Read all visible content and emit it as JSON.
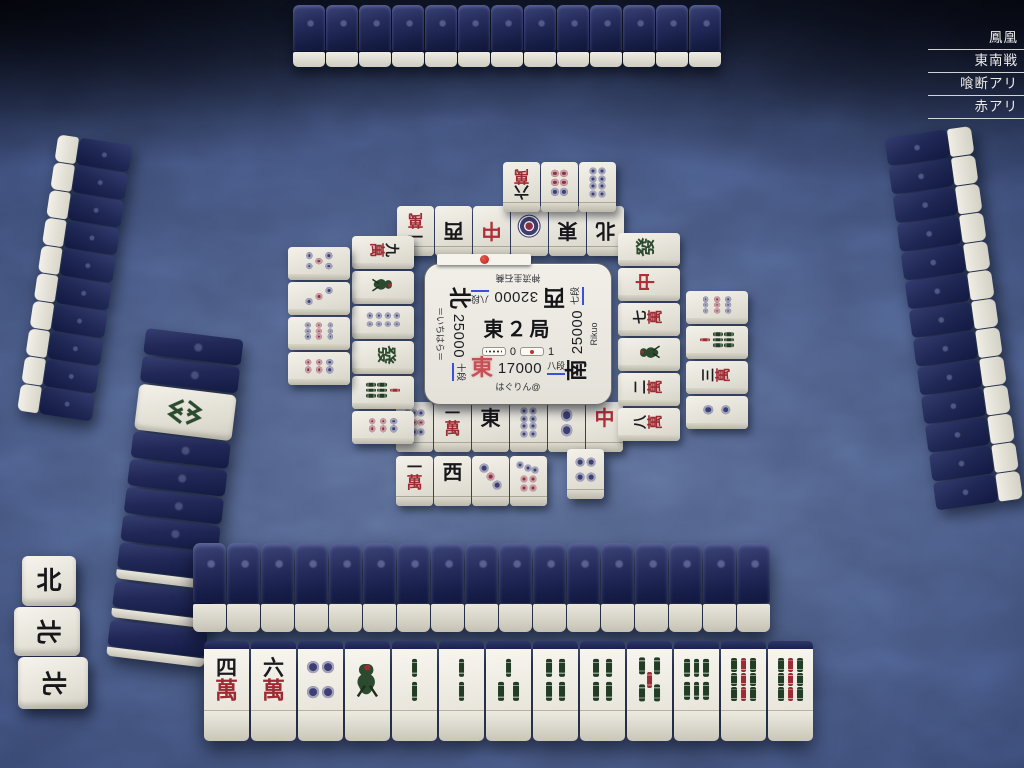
{
  "ruleset": {
    "items": [
      {
        "label": "鳳凰"
      },
      {
        "label": "東南戦"
      },
      {
        "label": "喰断アリ"
      },
      {
        "label": "赤アリ"
      }
    ]
  },
  "center_panel": {
    "round_label": "東２局",
    "hundred_sticks": "0",
    "riichi_sticks": "1",
    "players": {
      "bottom": {
        "wind": "東",
        "score": "17000",
        "rank": "八段",
        "name": "はぐりん@",
        "dealer": true
      },
      "right": {
        "wind": "南",
        "score": "25000",
        "rank": "七段",
        "name": "Rikuo",
        "dealer": false
      },
      "top": {
        "wind": "西",
        "score": "32000",
        "rank": "八段",
        "name": "神流圭石蕎",
        "dealer": false
      },
      "left": {
        "wind": "北",
        "score": "25000",
        "rank": "十段",
        "name": "＝いちはら＝",
        "dealer": false
      }
    }
  },
  "board": {
    "bottom_hand": [
      "4m",
      "6m",
      "4p",
      "1s",
      "2s",
      "2s",
      "3s",
      "4s",
      "4s",
      "5s",
      "6s",
      "9s",
      "9s"
    ],
    "discards": {
      "bottom": {
        "row1": [
          "9p",
          "1m",
          "E",
          "8p",
          "2p",
          "C"
        ],
        "row2": [
          "1m",
          "W",
          "3p",
          "7p"
        ],
        "latest": "4p"
      },
      "top": {
        "row1": [
          "1m",
          "W",
          "C",
          "1p",
          "E",
          "N"
        ],
        "row2": [
          "6m",
          "6p",
          "8p"
        ]
      },
      "left": {
        "row1": [
          "9m",
          "1s",
          "8p",
          "F",
          "7s",
          "6p"
        ],
        "row2": [
          "5p",
          "3p",
          "9p",
          "6p"
        ]
      },
      "right": {
        "row1": [
          "F",
          "C",
          "7m",
          "1s",
          "2m",
          "8m"
        ],
        "row2": [
          "9p",
          "7s",
          "3m",
          "2p"
        ]
      }
    },
    "left_meld": {
      "owner": "left",
      "tiles": [
        "N",
        "N",
        "N"
      ],
      "called_index": 0
    },
    "dora_indicator": "8s",
    "left_wall_slots": [
      "back",
      "back",
      "dora",
      "back",
      "back",
      "back",
      "back",
      "back2",
      "back2",
      "back2"
    ],
    "wall_counts": {
      "top_hand": 13,
      "right_hand": 13,
      "left_hand": 10,
      "bottom_wall": 17
    }
  },
  "glyphs": {
    "winds": {
      "E": "東",
      "S": "南",
      "W": "西",
      "N": "北"
    },
    "dragons": {
      "C": "中",
      "F": "發"
    },
    "man_numbers": {
      "1": "一",
      "2": "二",
      "3": "三",
      "4": "四",
      "5": "五",
      "6": "六",
      "7": "七",
      "8": "八",
      "9": "九"
    },
    "man_suffix": "萬"
  },
  "colors": {
    "dealer_wind": "#c75056",
    "man_red": "#9e2b33",
    "pin_blue": "#3d3f74",
    "pin_red": "#8c3145",
    "sou_green": "#223c26",
    "sou_red": "#9c2c34",
    "dragon_red": "#ae2f38",
    "dragon_green": "#2c4a2e",
    "rank_underline": "#3a50d8",
    "turn_dot": "#c22a2a"
  }
}
